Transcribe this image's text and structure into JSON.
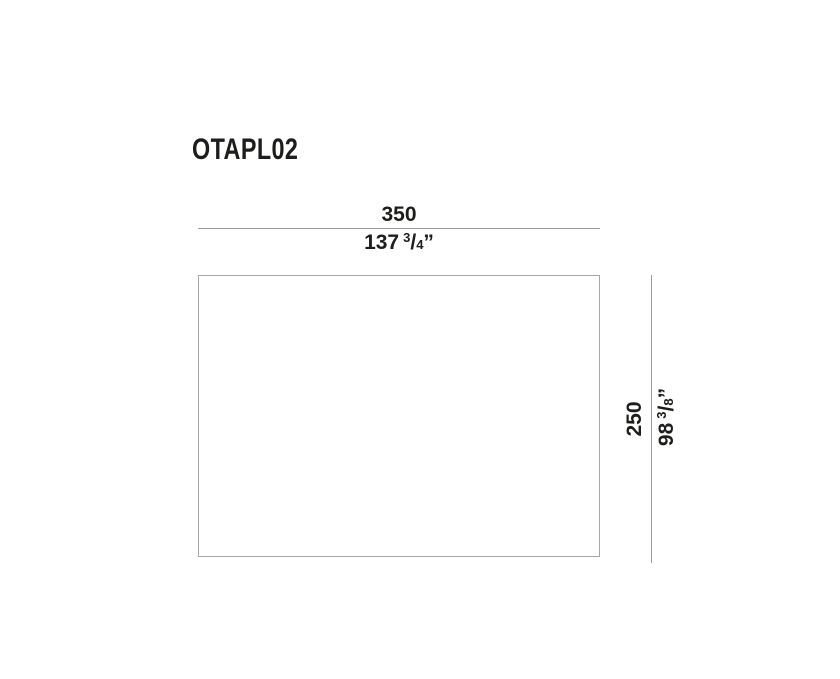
{
  "product": {
    "code": "OTAPL02"
  },
  "dimensions": {
    "width": {
      "metric": "350",
      "imperial_whole": "137",
      "imperial_numerator": "3",
      "imperial_slash": "/",
      "imperial_denominator": "4",
      "imperial_unit": "”"
    },
    "height": {
      "metric": "250",
      "imperial_whole": "98",
      "imperial_numerator": "3",
      "imperial_slash": "/",
      "imperial_denominator": "8",
      "imperial_unit": "”"
    }
  },
  "colors": {
    "line": "#9c9c9c",
    "outline": "#a6a6a6",
    "text": "#1d1d1b",
    "background": "#ffffff"
  }
}
